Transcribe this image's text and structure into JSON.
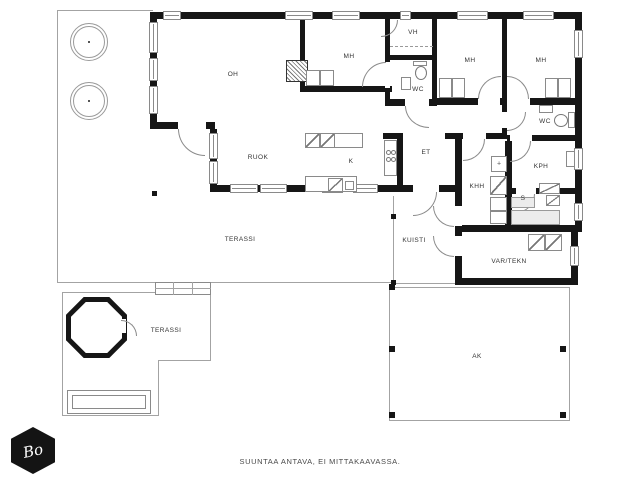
{
  "rooms": {
    "oh": "OH",
    "mh1": "MH",
    "vh": "VH",
    "wc1": "WC",
    "mh2": "MH",
    "mh3": "MH",
    "wc2": "WC",
    "ruok": "RUOK",
    "k": "K",
    "et": "ET",
    "khh": "KHH",
    "kph": "KPH",
    "s": "S",
    "kuisti": "KUISTI",
    "var_tekn": "VAR/TEKN",
    "terassi_main": "TERASSI",
    "terassi_lower": "TERASSI",
    "ak": "AK"
  },
  "footer": {
    "disclaimer": "SUUNTAA ANTAVA, EI MITTAKAAVASSA."
  },
  "logo": {
    "text": "Bo"
  },
  "colors": {
    "wall": "#161616",
    "line": "#a3a3a3",
    "bench": "#ececec",
    "paper": "#ffffff"
  }
}
